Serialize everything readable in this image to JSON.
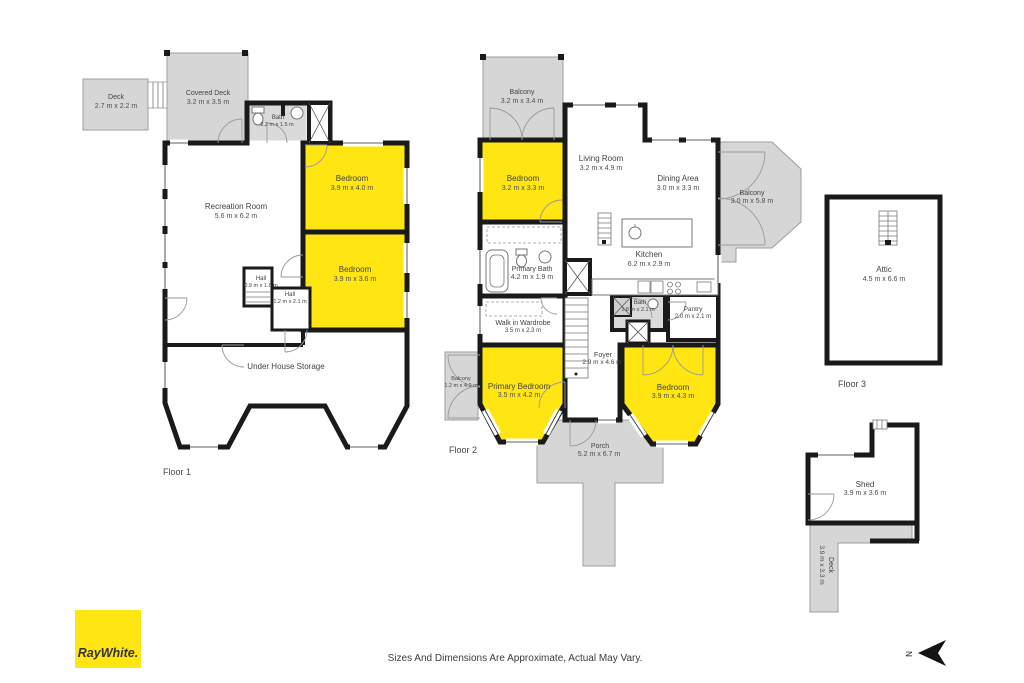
{
  "page": {
    "disclaimer": "Sizes And Dimensions Are Approximate, Actual May Vary.",
    "brand_logo": "RayWhite.",
    "north_label": "N",
    "colors": {
      "highlight": "#FFE512",
      "outdoor": "#D6D6D6",
      "wall": "#1a1a1a",
      "brand_yellow": "#FFE512"
    }
  },
  "floor1": {
    "caption": "Floor 1",
    "rooms": {
      "deck": {
        "name": "Deck",
        "dims": "2.7 m x 2.2 m"
      },
      "covered_deck": {
        "name": "Covered Deck",
        "dims": "3.2 m x 3.5 m"
      },
      "bath": {
        "name": "Bath",
        "dims": "2.2 m x 1.5 m"
      },
      "bedroom1": {
        "name": "Bedroom",
        "dims": "3.9 m x 4.0 m"
      },
      "recreation": {
        "name": "Recreation Room",
        "dims": "5.6 m x 6.2 m"
      },
      "bedroom2": {
        "name": "Bedroom",
        "dims": "3.9 m x 3.6 m"
      },
      "hall1": {
        "name": "Hall",
        "dims": "0.9 m x 1.8 m"
      },
      "hall2": {
        "name": "Hall",
        "dims": "1.2 m x 2.1 m"
      },
      "storage": {
        "name": "Under House Storage"
      }
    }
  },
  "floor2": {
    "caption": "Floor 2",
    "rooms": {
      "balcony_top": {
        "name": "Balcony",
        "dims": "3.2 m x 3.4 m"
      },
      "bedroom_top": {
        "name": "Bedroom",
        "dims": "3.2 m x 3.3 m"
      },
      "living": {
        "name": "Living Room",
        "dims": "3.2 m x 4.9 m"
      },
      "dining": {
        "name": "Dining Area",
        "dims": "3.0 m x 3.3 m"
      },
      "balcony_right": {
        "name": "Balcony",
        "dims": "3.0 m x 5.8 m"
      },
      "kitchen": {
        "name": "Kitchen",
        "dims": "6.2 m x 2.9 m"
      },
      "primary_bath": {
        "name": "Primary Bath",
        "dims": "4.2 m x 1.9 m"
      },
      "wardrobe": {
        "name": "Walk in Wardrobe",
        "dims": "3.5 m x 2.3 m"
      },
      "bath": {
        "name": "Bath",
        "dims": "1.8 m x 2.1 m"
      },
      "pantry": {
        "name": "Pantry",
        "dims": "2.0 m x 2.1 m"
      },
      "foyer": {
        "name": "Foyer",
        "dims": "2.9 m x 4.6 m"
      },
      "balcony_left": {
        "name": "Balcony",
        "dims": "1.2 m x 4.0 m"
      },
      "primary_bedroom": {
        "name": "Primary Bedroom",
        "dims": "3.5 m x 4.2 m"
      },
      "bedroom_bottom": {
        "name": "Bedroom",
        "dims": "3.9 m x 4.3 m"
      },
      "porch": {
        "name": "Porch",
        "dims": "5.2 m x 6.7 m"
      }
    }
  },
  "floor3": {
    "caption": "Floor 3",
    "rooms": {
      "attic": {
        "name": "Attic",
        "dims": "4.5 m x 6.6 m"
      }
    }
  },
  "outbuildings": {
    "shed": {
      "name": "Shed",
      "dims": "3.9 m x 3.6 m"
    },
    "deck": {
      "name": "Deck",
      "dims": "3.9 m x 3.3 m"
    }
  }
}
